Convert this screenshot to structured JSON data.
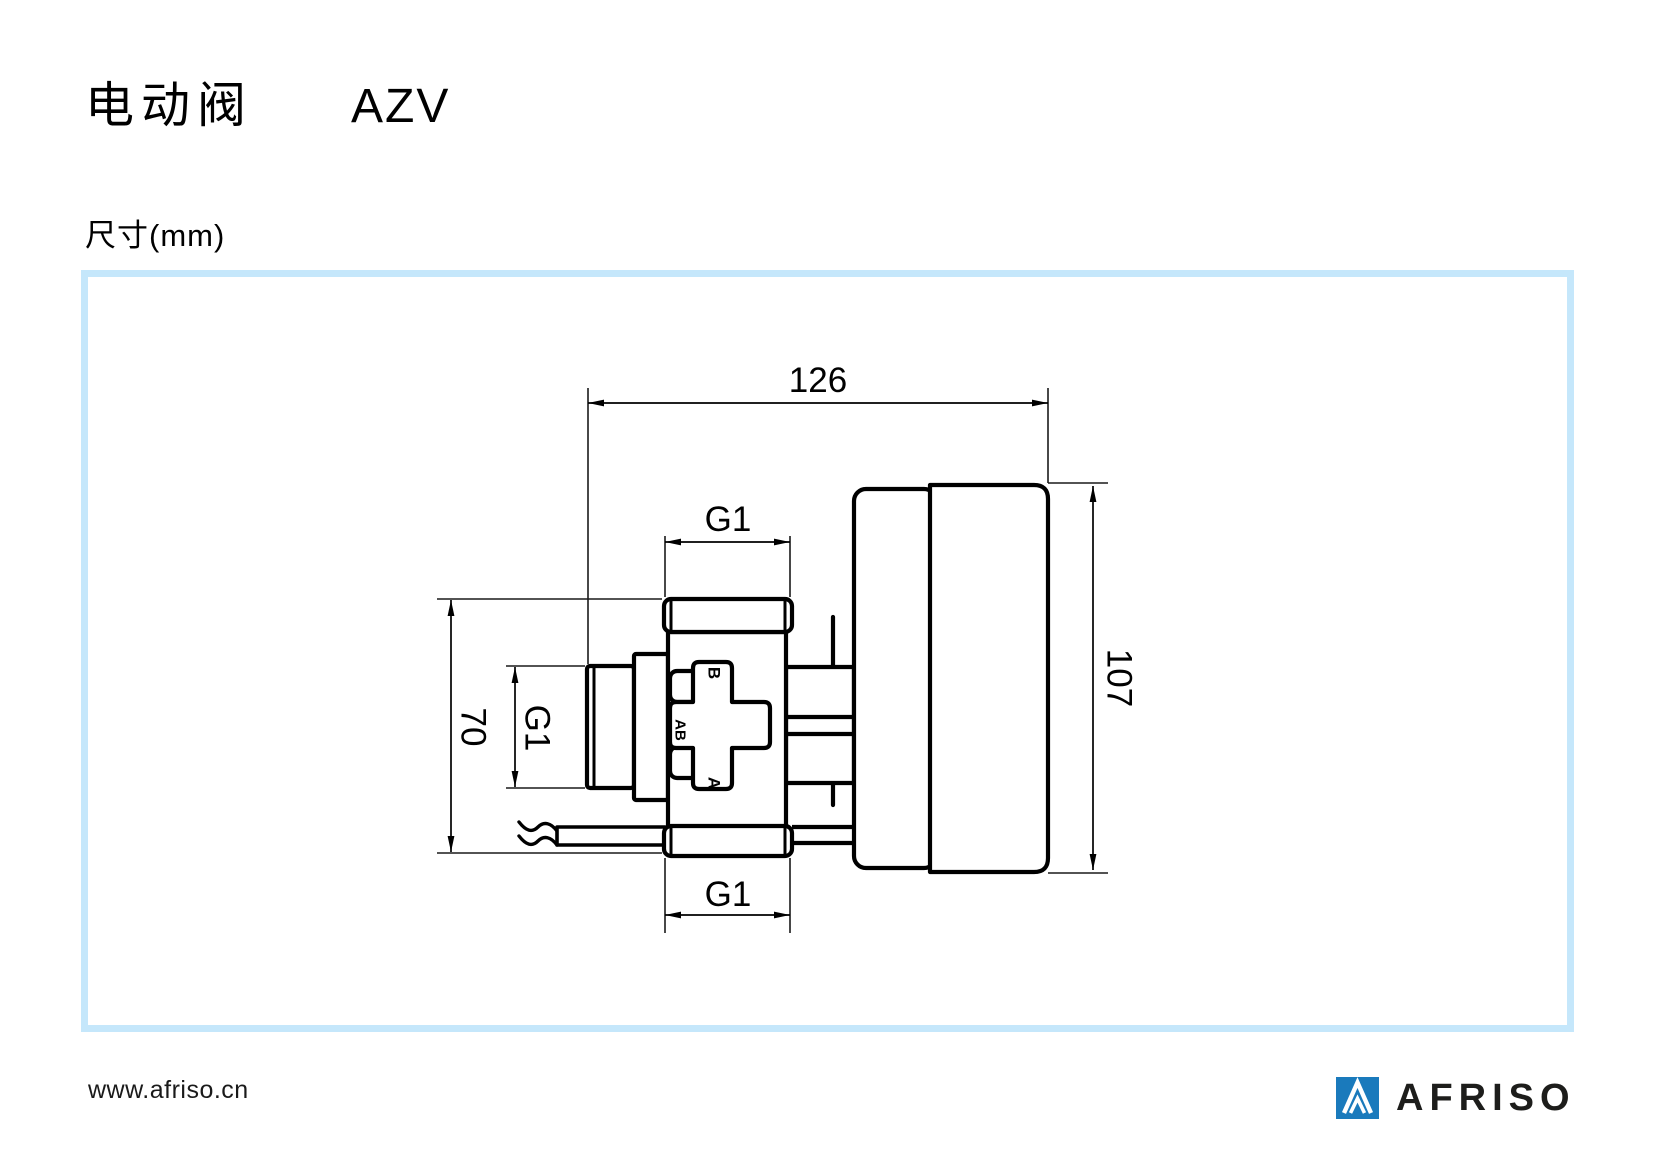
{
  "page": {
    "title_cn": "电动阀",
    "title_model": "AZV",
    "subtitle": "尺寸(mm)"
  },
  "drawing": {
    "dimensions": {
      "total_width": "126",
      "actuator_height": "107",
      "valve_height": "70",
      "thread_top": "G1",
      "thread_left": "G1",
      "thread_bottom": "G1"
    },
    "port_labels": {
      "top_port": "B",
      "mix_port": "AB",
      "bottom_port": "A"
    }
  },
  "footer": {
    "website": "www.afriso.cn",
    "brand": "AFRISO"
  },
  "colors": {
    "frame_border": "#c5e7fb",
    "logo_blue": "#1a7abc",
    "line_black": "#000000"
  }
}
